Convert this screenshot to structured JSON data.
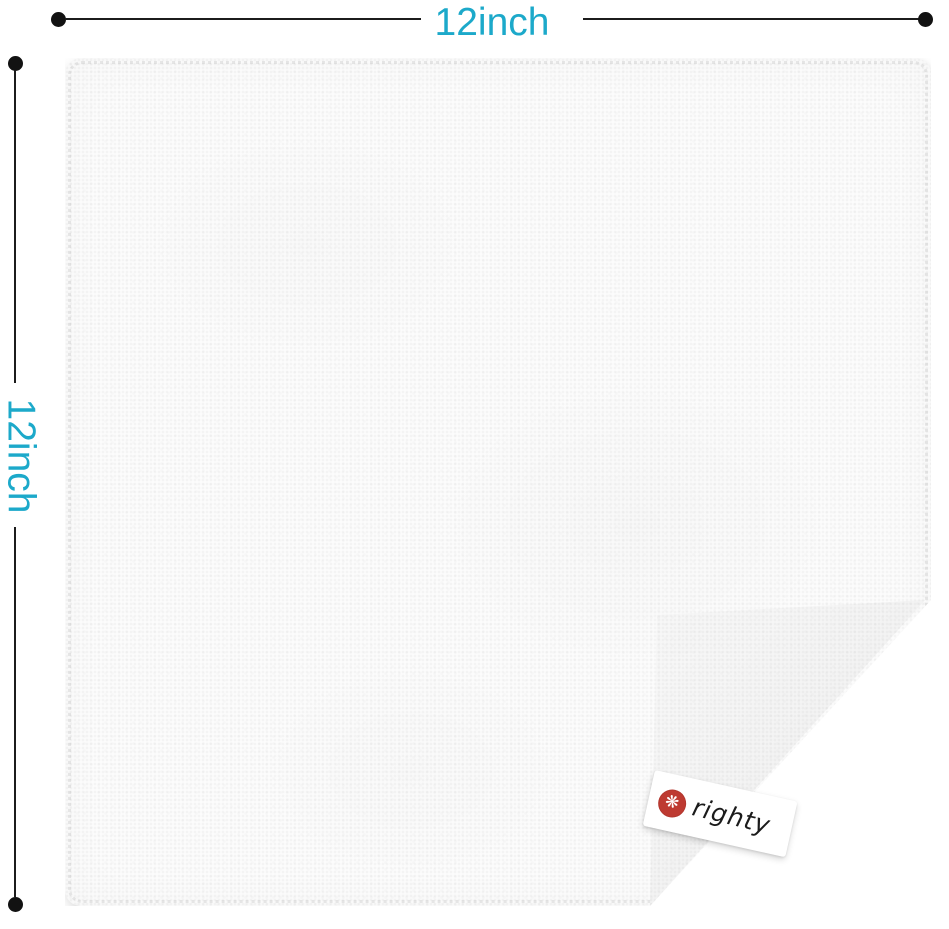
{
  "page": {
    "background": "#ffffff",
    "description": "white microfiber cloth product photo with size annotations"
  },
  "dimensions": {
    "top": {
      "label": "12inch"
    },
    "left": {
      "label": "12inch"
    },
    "label_color": "#1CA9CA",
    "line_color": "#1c1c1c"
  },
  "product": {
    "cloth_color": "#fcfcfc",
    "fold": "bottom-right corner folded up"
  },
  "tag": {
    "brand": "righty",
    "logo_icon": "hand-swirl-icon",
    "logo_glyph": "❋",
    "logo_color": "#BE3A31",
    "background": "#ffffff",
    "text_color": "#1b1b1b"
  }
}
